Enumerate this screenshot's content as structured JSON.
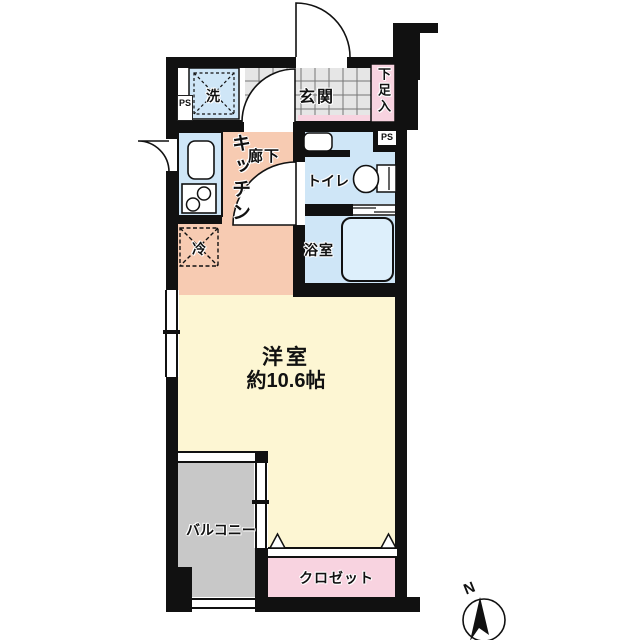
{
  "floorplan": {
    "title": "apartment floor plan",
    "rooms": {
      "entrance": {
        "label": "玄関"
      },
      "shoe_storage": {
        "label": "下足入"
      },
      "washer": {
        "label": "洗"
      },
      "kitchen": {
        "label": "キッチン"
      },
      "corridor": {
        "label": "廊下"
      },
      "refrigerator": {
        "label": "冷"
      },
      "toilet": {
        "label": "トイレ"
      },
      "bathroom": {
        "label": "浴室"
      },
      "main_room": {
        "label": "洋室",
        "size": "約10.6帖"
      },
      "balcony": {
        "label": "バルコニー"
      },
      "closet": {
        "label": "クロゼット"
      }
    },
    "pipe_space_left": "PS",
    "pipe_space_right": "PS",
    "compass": {
      "north": "N"
    },
    "colors": {
      "wall": "#111111",
      "kitchen_floor": "#f7cbb2",
      "room_floor": "#fdf6d3",
      "wet_area_blue": "#cfe6f7",
      "storage_pink": "#f8d3e0",
      "balcony_gray": "#c8c8c8",
      "entrance_tile": "#e6e6e6"
    }
  }
}
